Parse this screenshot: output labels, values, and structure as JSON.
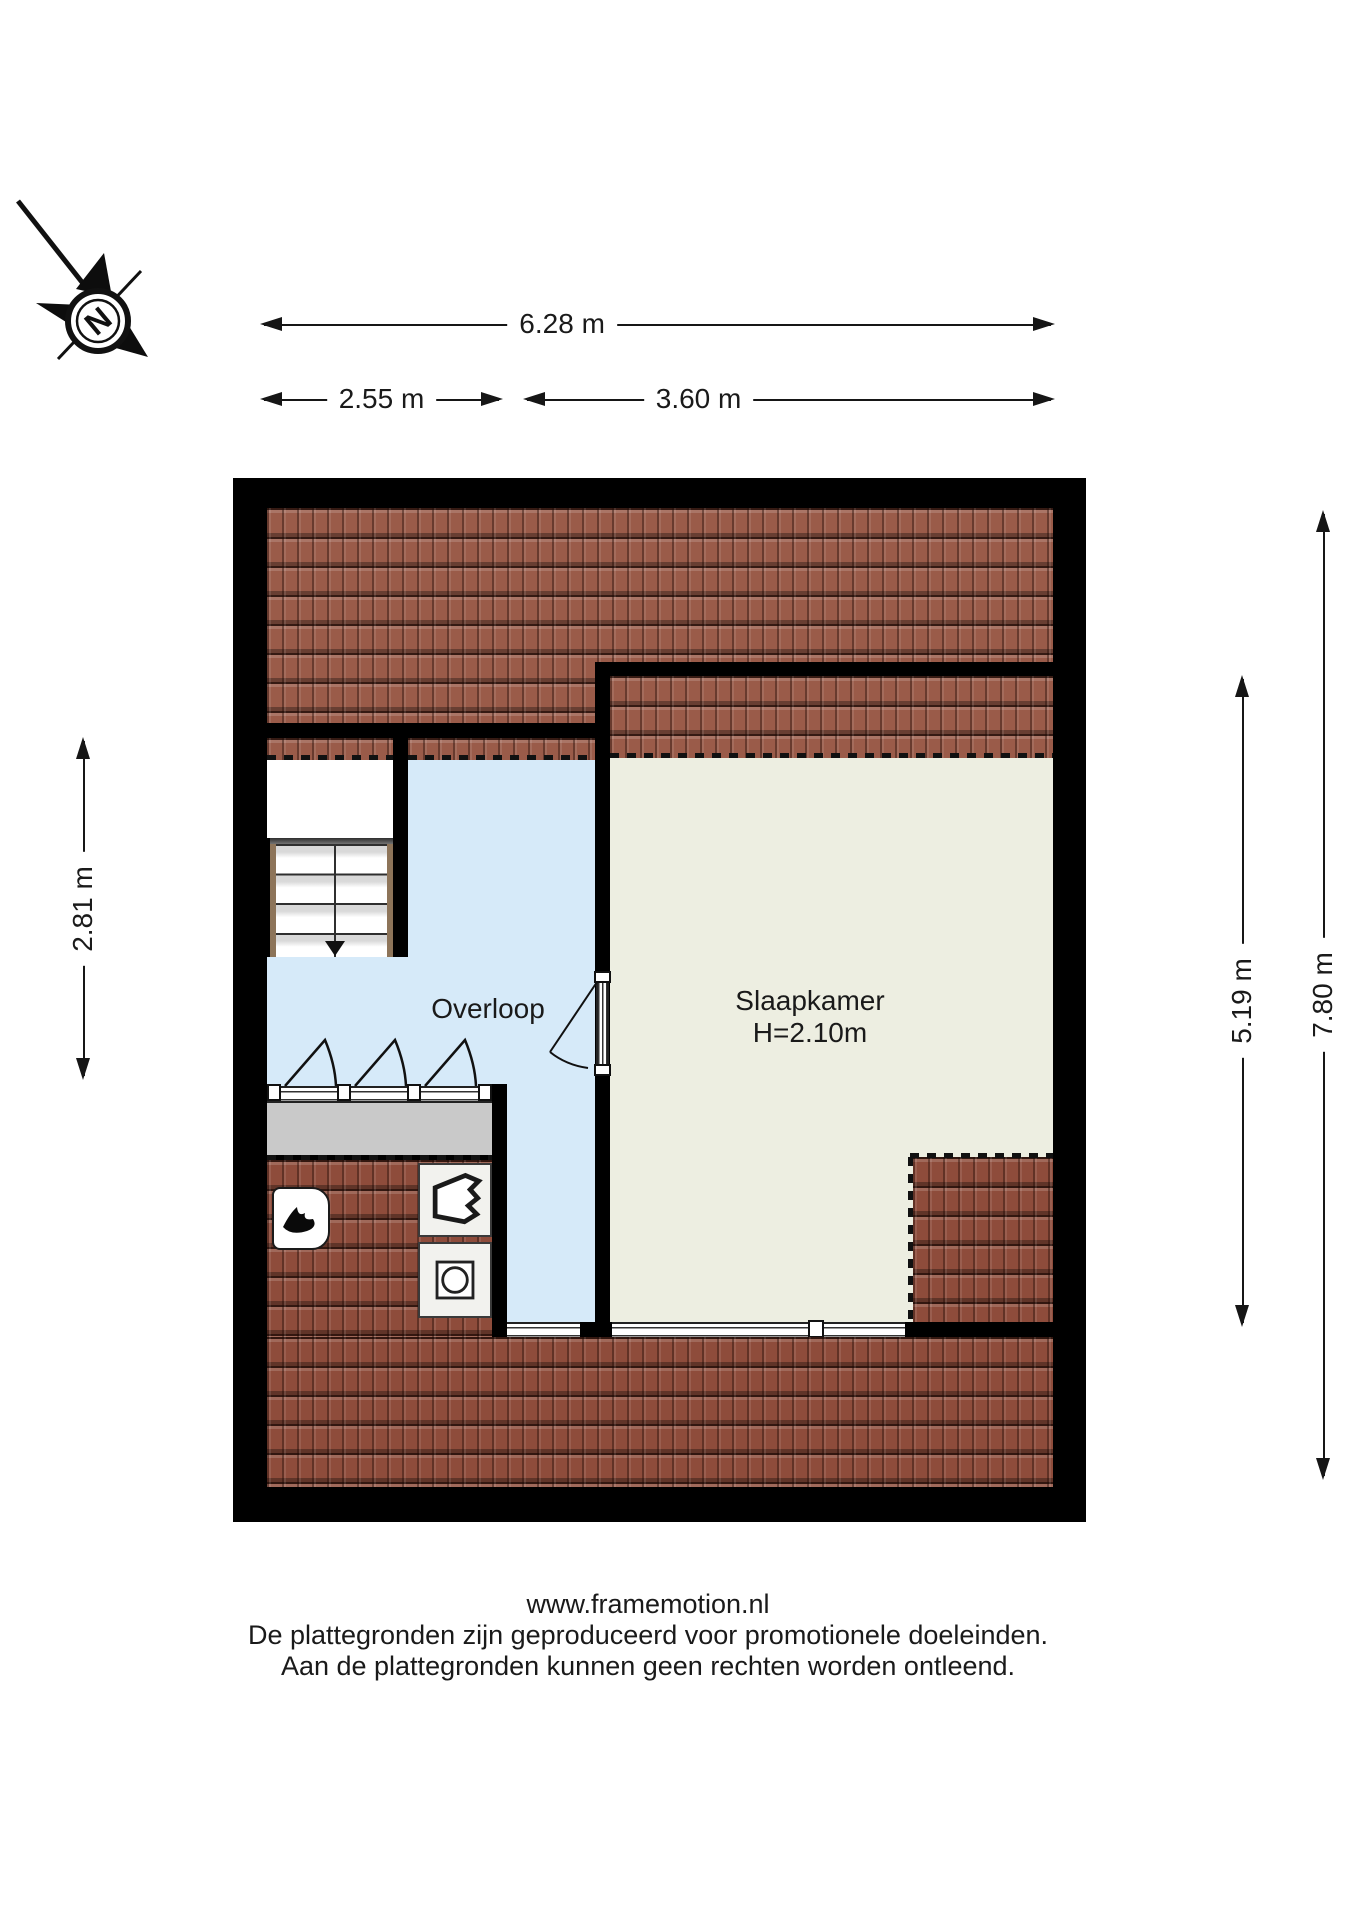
{
  "compass": {
    "label": "N"
  },
  "dimensions": {
    "total_width": {
      "label": "6.28 m"
    },
    "left_width": {
      "label": "2.55 m"
    },
    "right_width": {
      "label": "3.60 m"
    },
    "landing_depth": {
      "label": "2.81 m"
    },
    "bedroom_depth": {
      "label": "5.19 m"
    },
    "total_depth": {
      "label": "7.80 m"
    }
  },
  "rooms": {
    "overloop": {
      "label": "Overloop"
    },
    "slaapkamer": {
      "label": "Slaapkamer",
      "ceiling_height": "H=2.10m"
    }
  },
  "icons": {
    "compass_rose": "compass-rose-icon",
    "boiler": "boiler-flame-icon",
    "ventilation": "ventilation-unit-icon",
    "washing_machine": "washing-machine-icon",
    "stairs_down": "stairs-down-arrow-icon",
    "door_swing": "door-swing-arc-icon",
    "window_swing": "roof-window-swing-icon"
  },
  "footer": {
    "line1": "www.framemotion.nl",
    "line2": "De plattegronden zijn geproduceerd voor promotionele doeleinden.",
    "line3": "Aan de plattegronden kunnen geen rechten worden ontleend."
  },
  "colors": {
    "wall": "#000000",
    "roof_tile": "#9a5b49",
    "roof_tile_dark": "#8e4c3b",
    "landing_floor": "#d6eaf9",
    "bedroom_floor": "#edeee1",
    "dormer_strip": "#c9c9c9",
    "stair_rail": "#8d7459"
  }
}
